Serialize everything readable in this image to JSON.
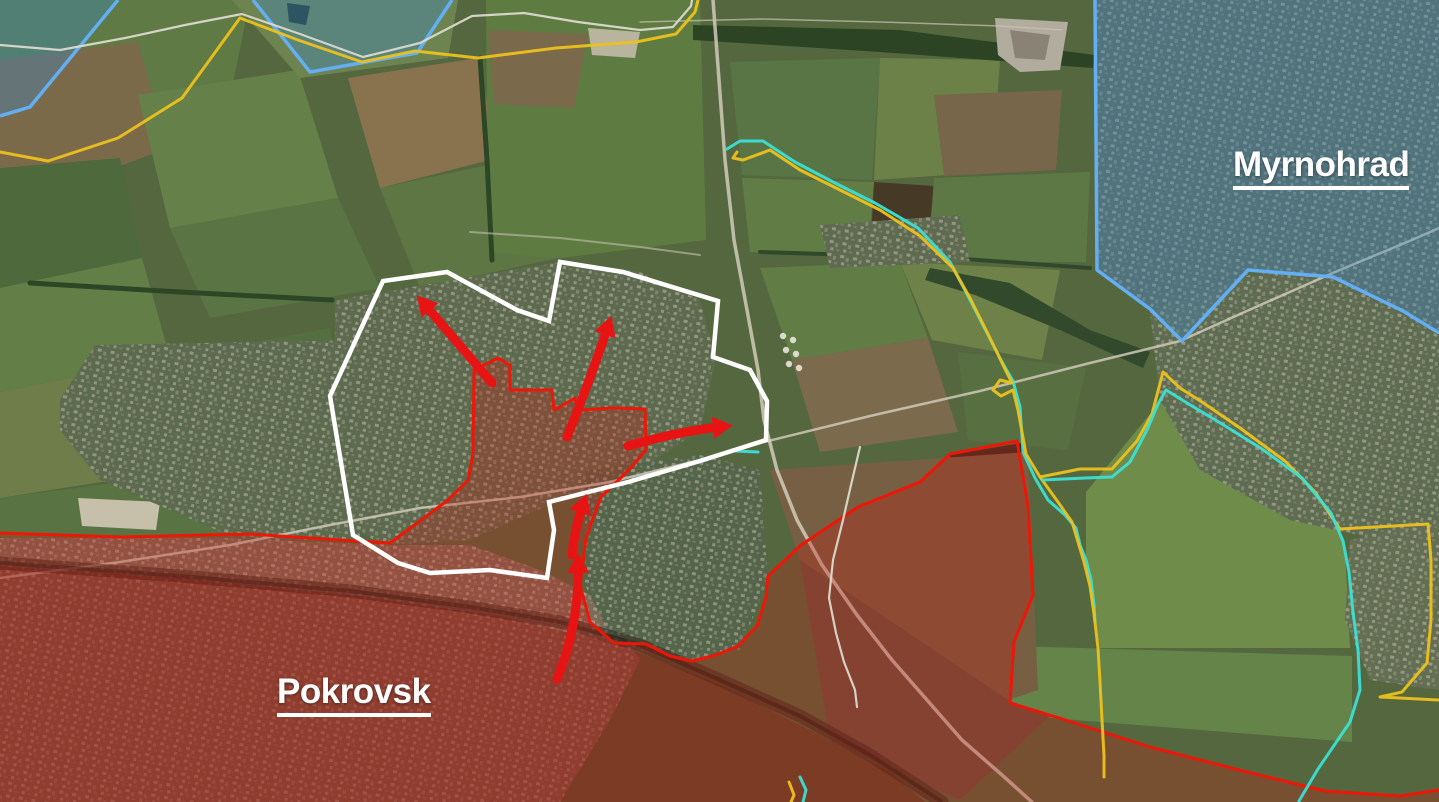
{
  "map": {
    "kind": "satellite-situation-map"
  },
  "labels": {
    "city_left": "Pokrovsk",
    "city_right": "Myrnohrad"
  },
  "colors": {
    "red_line": "#ee1606",
    "red_fill": "rgba(200,25,15,0.30)",
    "red_core_fill": "rgba(135,12,8,0.30)",
    "white_line": "#ffffff",
    "blue_line": "#64aef2",
    "blue_fill": "rgba(62,136,200,0.36)",
    "yellow_line": "#edc11d",
    "cyan_line": "#3be0d4",
    "gray_line": "#dbd9ce",
    "arrow": "#e81414",
    "label_text": "#ffffff"
  },
  "zones": [
    {
      "id": "red-zone-south",
      "line_color": "#ee1606"
    },
    {
      "id": "white-pocket-center",
      "line_color": "#ffffff"
    },
    {
      "id": "blue-zone-right",
      "line_color": "#64aef2"
    },
    {
      "id": "blue-zone-top-left",
      "line_color": "#64aef2"
    }
  ],
  "arrows": {
    "count": 5,
    "color": "#e81414"
  }
}
